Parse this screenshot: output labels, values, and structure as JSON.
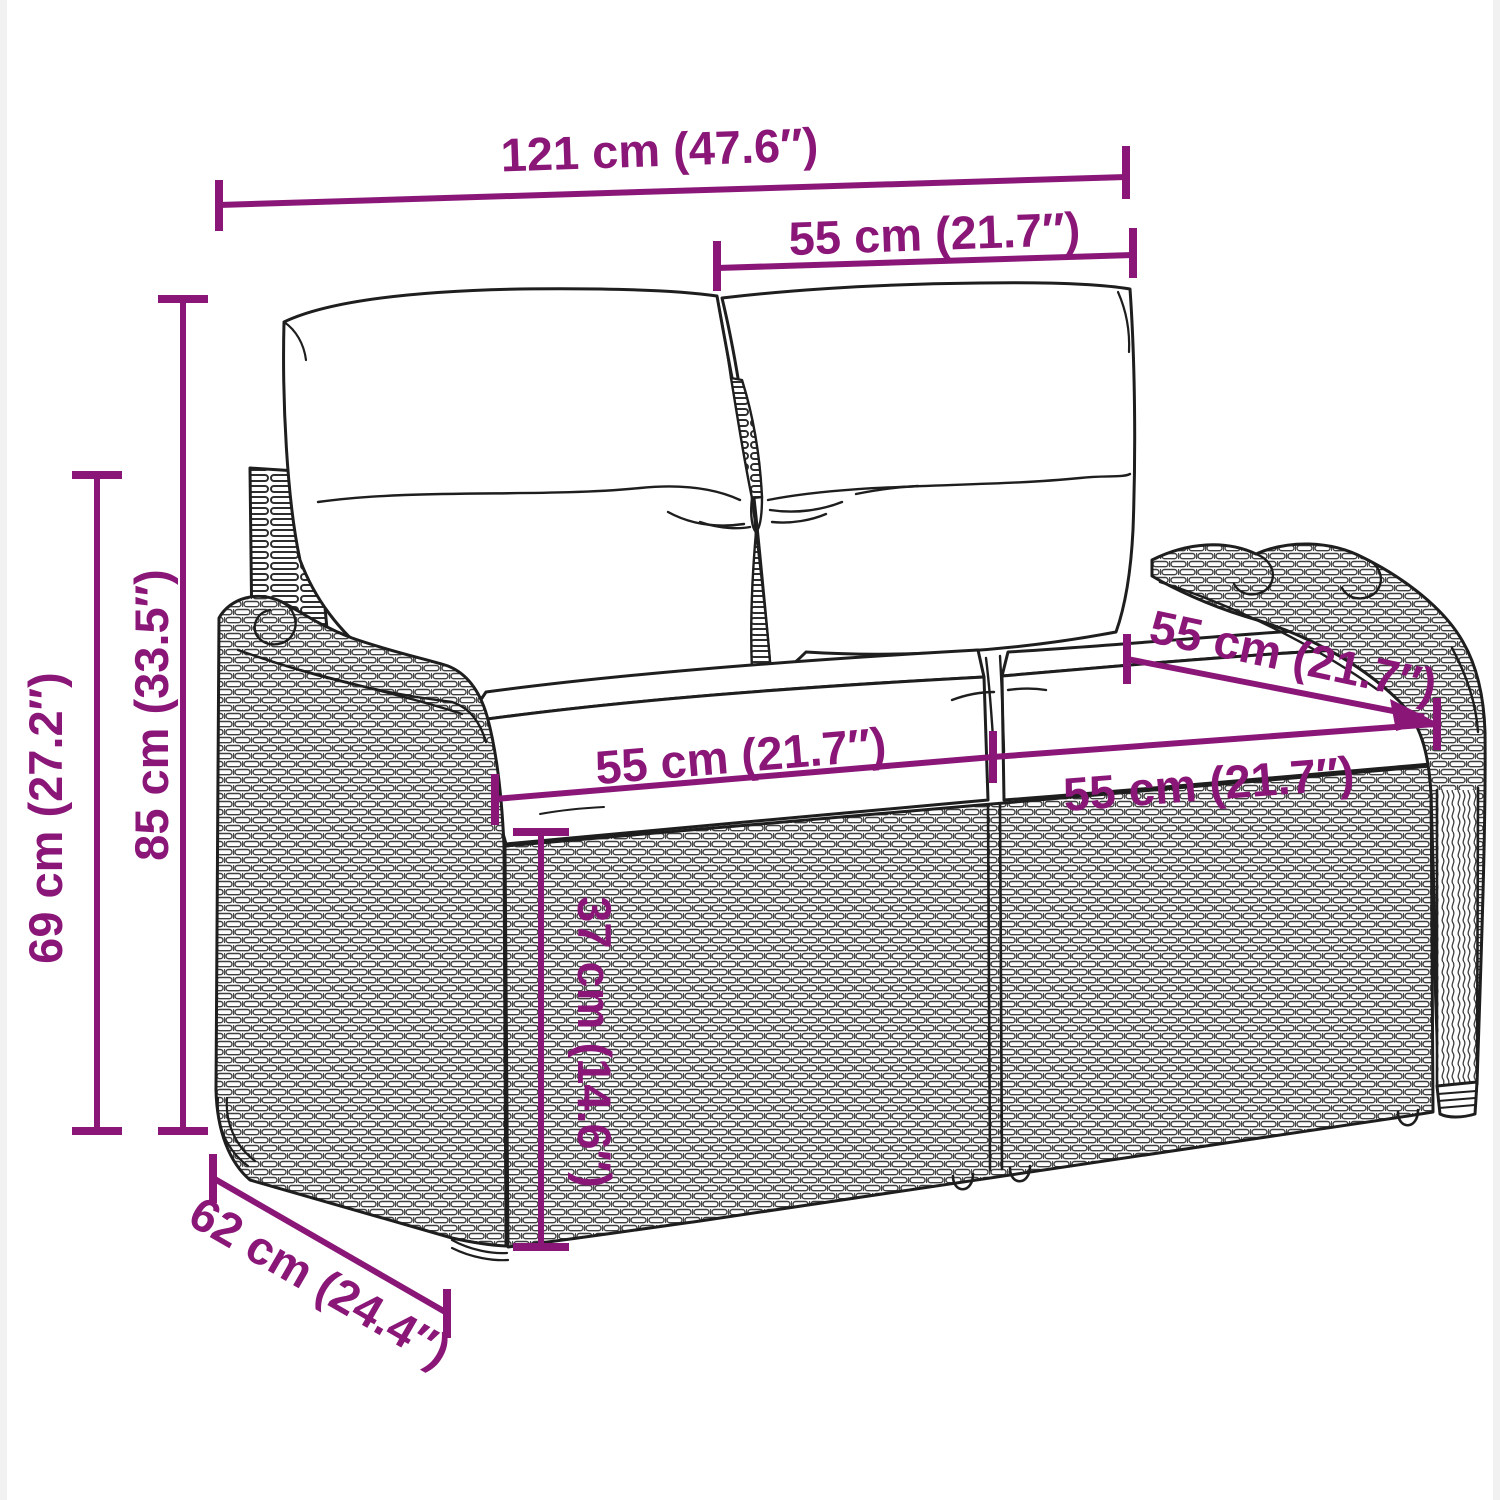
{
  "figure": {
    "type": "product dimension diagram",
    "subject": "2-seater poly rattan garden bench with back and seat cushions",
    "view": "three-quarter front line drawing"
  },
  "colors": {
    "accent": "#8A1778",
    "line_art": "#1E1E1E",
    "background": "#FFFFFF"
  },
  "dimensions": {
    "overall_width": {
      "label": "121 cm (47.6″)",
      "cm": 121,
      "in": 47.6
    },
    "backrest_width": {
      "label": "55 cm (21.7″)",
      "cm": 55,
      "in": 21.7
    },
    "total_height": {
      "label": "85 cm (33.5″)",
      "cm": 85,
      "in": 33.5
    },
    "armrest_height": {
      "label": "69 cm (27.2″)",
      "cm": 69,
      "in": 27.2
    },
    "seat_width_left": {
      "label": "55 cm (21.7″)",
      "cm": 55,
      "in": 21.7
    },
    "seat_width_right": {
      "label": "55 cm (21.7″)",
      "cm": 55,
      "in": 21.7
    },
    "seat_depth": {
      "label": "55 cm (21.7″)",
      "cm": 55,
      "in": 21.7
    },
    "seat_height": {
      "label": "37 cm (14.6″)",
      "cm": 37,
      "in": 14.6
    },
    "base_depth": {
      "label": "62 cm (24.4″)",
      "cm": 62,
      "in": 24.4
    }
  }
}
